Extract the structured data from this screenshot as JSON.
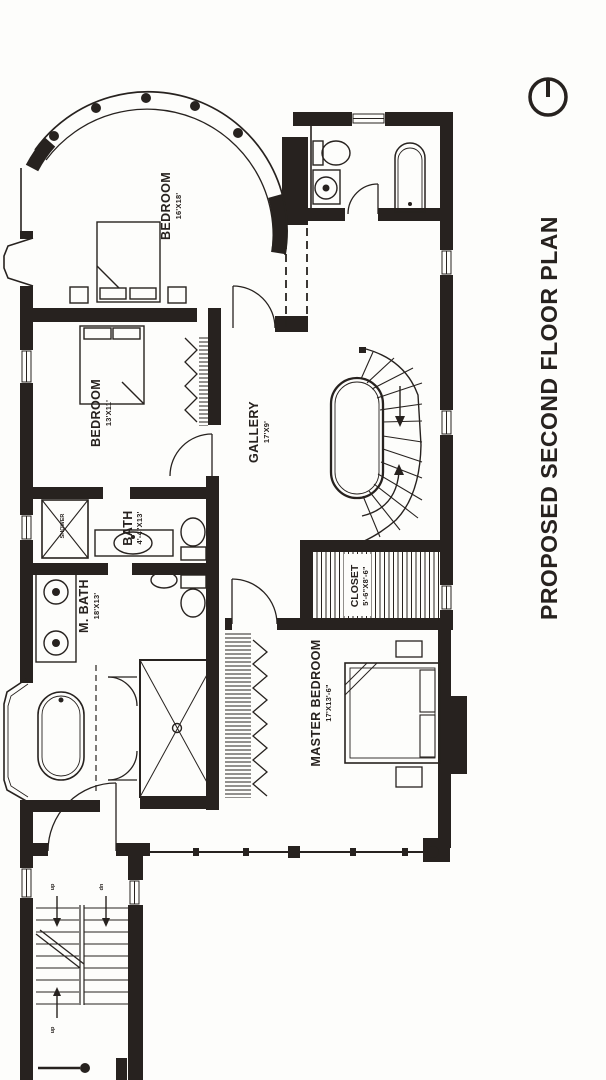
{
  "title": "PROPOSED SECOND FLOOR PLAN",
  "colors": {
    "ink": "#27221f",
    "paper": "#fdfdfb"
  },
  "rooms": [
    {
      "name": "BEDROOM",
      "dims": "16'X18'"
    },
    {
      "name": "BEDROOM",
      "dims": "13'X11'"
    },
    {
      "name": "GALLERY",
      "dims": "17'X9'"
    },
    {
      "name": "BATH",
      "dims": "4'-4\"X13'"
    },
    {
      "name": "SHOWER",
      "dims": ""
    },
    {
      "name": "M. BATH",
      "dims": "18'X13'"
    },
    {
      "name": "CLOSET",
      "dims": "5'-6\"X8'-6\""
    },
    {
      "name": "MASTER BEDROOM",
      "dims": "17'X13'-6\""
    }
  ],
  "stairs": {
    "direction_labels": [
      "up",
      "dn",
      "up"
    ]
  }
}
